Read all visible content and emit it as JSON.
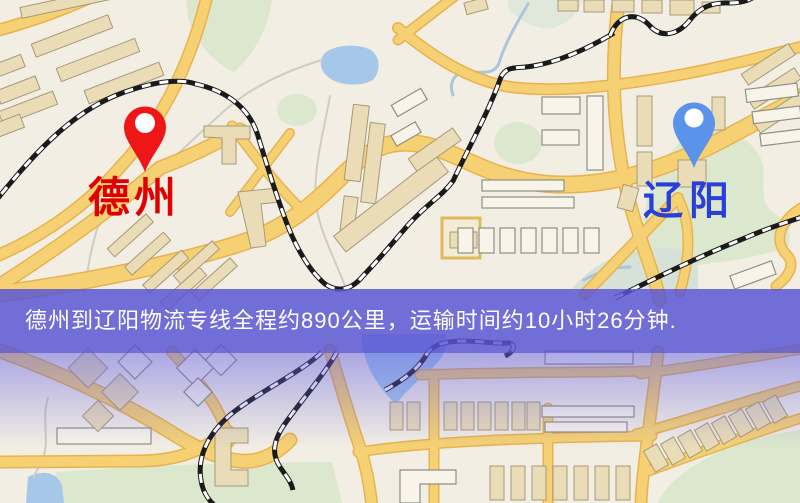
{
  "banner": {
    "text": "德州到辽阳物流专线全程约890公里，运输时间约10小时26分钟.",
    "background_color": "#5855d5",
    "text_color": "#ffffff"
  },
  "markers": {
    "origin": {
      "label": "德州",
      "pin_color": "#ee1616",
      "label_color": "#e00000"
    },
    "destination": {
      "label": "辽阳",
      "pin_color": "#5b93ea",
      "label_color": "#2a3fd8"
    }
  },
  "route": {
    "distance_text": "约890公里",
    "duration_text": "约10小时26分钟"
  },
  "map": {
    "type": "static-road-map",
    "colors": {
      "background": "#f2eee3",
      "road_fill": "#f6d173",
      "road_casing": "#e8b34f",
      "building": "#e9dcb6",
      "building_outline": "#f8f4e9",
      "park": "#dce8cd",
      "water": "#a6c8e8",
      "railway": "#1a1a1a",
      "below_banner_tint": "#6460e2"
    }
  }
}
